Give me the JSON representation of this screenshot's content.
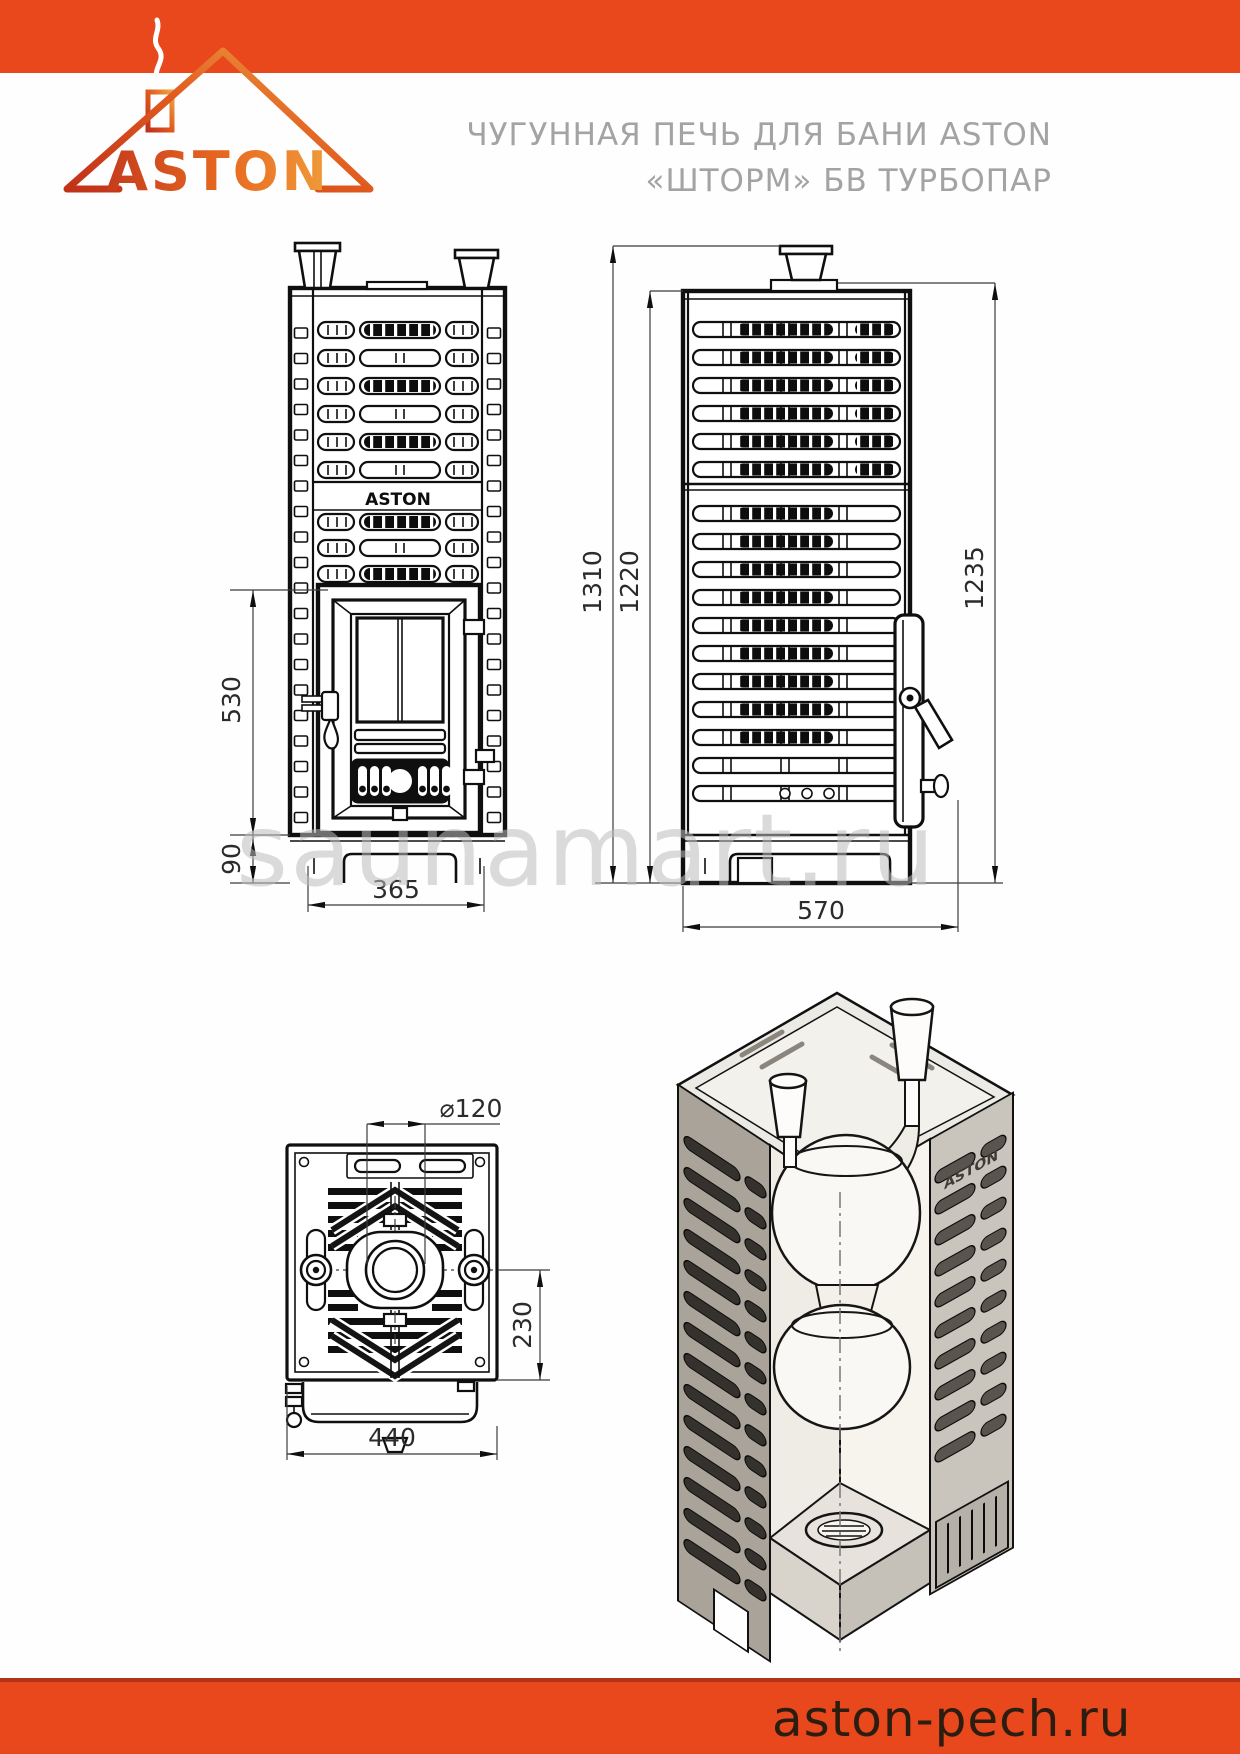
{
  "page": {
    "brand": "ASTON",
    "title_line1": "ЧУГУННАЯ ПЕЧЬ ДЛЯ БАНИ ASTON",
    "title_line2": "«ШТОРМ» БВ ТУРБОПАР",
    "watermark": "saunamart.ru",
    "footer_url": "aston-pech.ru"
  },
  "colors": {
    "accent": "#E8481C",
    "accent_dark": "#B23417",
    "title_gray": "#A3A3A3",
    "watermark": "#BDBDBD",
    "footer_text": "#2B1D10",
    "line": "#111111"
  },
  "views": {
    "front": {
      "label": "front-view",
      "logo_plate": "ASTON",
      "dims": {
        "firebox_height": "530",
        "base_height": "90",
        "width": "365"
      }
    },
    "side": {
      "label": "side-view",
      "dims": {
        "overall_height": "1310",
        "body_height": "1220",
        "cage_height": "1235",
        "depth": "570"
      }
    },
    "top": {
      "label": "top-view",
      "dims": {
        "flue_diameter": "⌀120",
        "flue_center_offset": "230",
        "width": "440"
      }
    },
    "iso": {
      "label": "isometric-cutaway"
    }
  }
}
